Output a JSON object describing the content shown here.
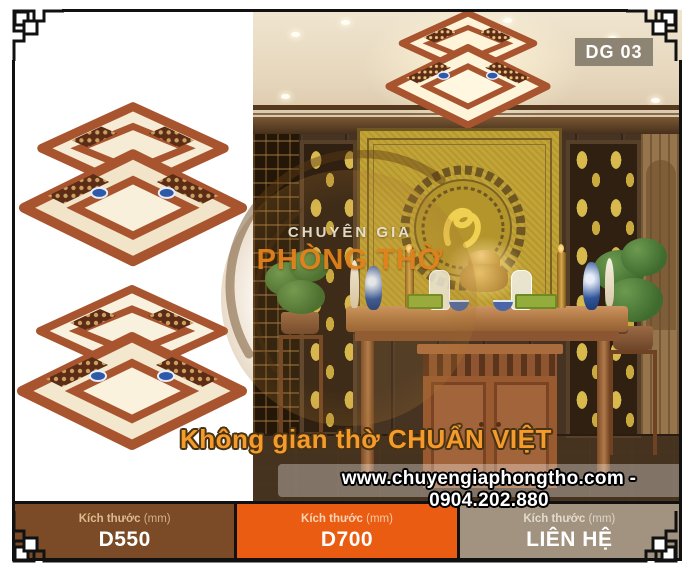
{
  "badge": {
    "label": "DG 03"
  },
  "watermark": {
    "brand_top": "CHUYÊN GIA",
    "brand_bottom": "PHÒNG THỜ",
    "top_color": "#e9e3d3",
    "bottom_color": "#e2821c"
  },
  "overlay": {
    "tagline": "Không gian thờ CHUẨN VIỆT",
    "tagline_color": "#f49b2b",
    "contact": "www.chuyengiaphongtho.com - 0904.202.880",
    "contact_color": "#ffffff"
  },
  "size_bars": {
    "items": [
      {
        "label": "Kích thước",
        "unit": "(mm)",
        "value": "D550",
        "bg": "#7a4b26",
        "label_color": "#debb8f"
      },
      {
        "label": "Kích thước",
        "unit": "(mm)",
        "value": "D700",
        "bg": "#e95c12",
        "label_color": "#fad4b6"
      },
      {
        "label": "Kích thước",
        "unit": "(mm)",
        "value": "LIÊN HỆ",
        "bg": "#a29380",
        "label_color": "#e3dacb"
      }
    ]
  },
  "colors": {
    "frame": "#111111",
    "badge_bg": "#8d8473",
    "gold_panel": "#c2a436",
    "wood_lamp": "#a8542f",
    "accent_orange": "#e95c12"
  }
}
